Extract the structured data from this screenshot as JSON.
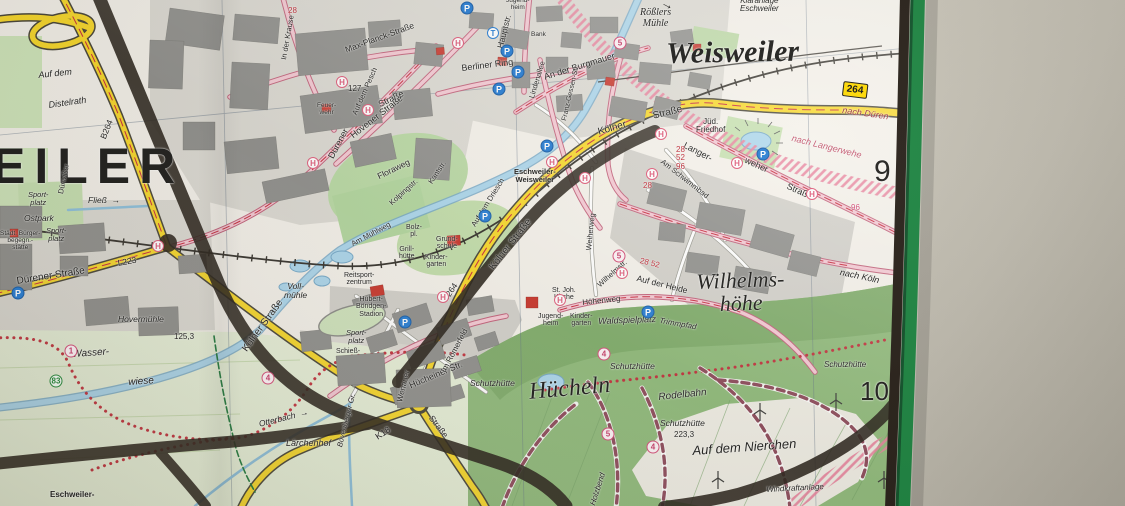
{
  "map": {
    "towns": [
      {
        "t": "Weisweiler"
      },
      {
        "t": "EILER"
      },
      {
        "t": "Wilhelms-\nhöhe"
      },
      {
        "t": "Hücheln"
      }
    ],
    "grid": [
      "9",
      "10"
    ],
    "labels": [
      {
        "t": "Rößlers\nMühle",
        "x": 640,
        "y": 8,
        "fs": 10,
        "s": "i ser ctr"
      },
      {
        "t": "Kläranlage\nEschweiler",
        "x": 740,
        "y": -3,
        "fs": 8,
        "s": "i ctr"
      },
      {
        "t": "nach Düren",
        "x": 843,
        "y": 106,
        "fs": 9,
        "r": 8,
        "s": "i",
        "c": "#9b2d35"
      },
      {
        "t": "nach Langerwehe",
        "x": 793,
        "y": 134,
        "fs": 9,
        "r": 14,
        "s": "i",
        "c": "#c2566e"
      },
      {
        "t": "nach Köln",
        "x": 841,
        "y": 268,
        "fs": 9,
        "r": 12,
        "s": "i"
      },
      {
        "t": "Jüd.\nFriedhof",
        "x": 696,
        "y": 118,
        "fs": 8,
        "s": "ctr"
      },
      {
        "t": "Langer-",
        "x": 686,
        "y": 141,
        "fs": 9,
        "r": 27
      },
      {
        "t": "weher",
        "x": 747,
        "y": 156,
        "fs": 9,
        "r": 24
      },
      {
        "t": "Straße",
        "x": 789,
        "y": 182,
        "fs": 9,
        "r": 24
      },
      {
        "t": "28\n52\n96",
        "x": 676,
        "y": 146,
        "fs": 8,
        "s": "ctr",
        "c": "#bf2f3a"
      },
      {
        "t": "Am Schwimmbad",
        "x": 664,
        "y": 158,
        "fs": 7.5,
        "r": 38
      },
      {
        "t": "Auf der Heide",
        "x": 638,
        "y": 274,
        "fs": 8.5,
        "r": 14
      },
      {
        "t": "28 52",
        "x": 641,
        "y": 257,
        "fs": 8,
        "r": 14,
        "c": "#bf2f3a"
      },
      {
        "t": "96",
        "x": 851,
        "y": 204,
        "fs": 8,
        "c": "#d4507a"
      },
      {
        "t": "28",
        "x": 643,
        "y": 182,
        "fs": 8,
        "c": "#bf2f3a"
      },
      {
        "t": "Kölner",
        "x": 597,
        "y": 128,
        "fs": 10,
        "r": -16
      },
      {
        "t": "Straße",
        "x": 652,
        "y": 112,
        "fs": 10,
        "r": -14
      },
      {
        "t": "Kölner Straße",
        "x": 488,
        "y": 266,
        "fs": 10,
        "r": -52
      },
      {
        "t": "B264",
        "x": 441,
        "y": 298,
        "fs": 8.5,
        "r": -56
      },
      {
        "t": "B264",
        "x": 99,
        "y": 137,
        "fs": 8.5,
        "r": -68
      },
      {
        "t": "Kölner Straße",
        "x": 241,
        "y": 348,
        "fs": 10,
        "r": -54
      },
      {
        "t": "Dürener Straße",
        "x": 16,
        "y": 277,
        "fs": 10,
        "r": -9
      },
      {
        "t": "L223",
        "x": 117,
        "y": 259,
        "fs": 8.5,
        "r": -10
      },
      {
        "t": "K18",
        "x": 374,
        "y": 434,
        "fs": 9,
        "r": -33
      },
      {
        "t": "Wenauer",
        "x": 396,
        "y": 401,
        "fs": 8,
        "r": -76
      },
      {
        "t": "Straße",
        "x": 434,
        "y": 414,
        "fs": 8.5,
        "r": 52
      },
      {
        "t": "Dürener",
        "x": 327,
        "y": 156,
        "fs": 9,
        "r": -62
      },
      {
        "t": "Straße",
        "x": 377,
        "y": 101,
        "fs": 9,
        "r": -26
      },
      {
        "t": "Hovener Straße",
        "x": 349,
        "y": 133,
        "fs": 9,
        "r": -38
      },
      {
        "t": "Max-Planck-Straße",
        "x": 344,
        "y": 46,
        "fs": 8.5,
        "r": -20
      },
      {
        "t": "Auf dem Pesch",
        "x": 351,
        "y": 113,
        "fs": 7.5,
        "r": -66
      },
      {
        "t": "In der Krause",
        "x": 280,
        "y": 59,
        "fs": 7.5,
        "r": -80
      },
      {
        "t": "Berliner Ring",
        "x": 461,
        "y": 64,
        "fs": 9,
        "r": -7
      },
      {
        "t": "Hauptstr.",
        "x": 496,
        "y": 47,
        "fs": 8.5,
        "r": -76
      },
      {
        "t": "An der Burgmauer",
        "x": 543,
        "y": 73,
        "fs": 9,
        "r": -17
      },
      {
        "t": "Franz-Gessen-Str.",
        "x": 561,
        "y": 120,
        "fs": 7,
        "r": -77
      },
      {
        "t": "Lindenallee",
        "x": 528,
        "y": 97,
        "fs": 7.5,
        "r": -73
      },
      {
        "t": "Floraweg",
        "x": 376,
        "y": 173,
        "fs": 8.5,
        "r": -26
      },
      {
        "t": "Kolpingstr.",
        "x": 388,
        "y": 201,
        "fs": 7.5,
        "r": -42
      },
      {
        "t": "Kantstr.",
        "x": 427,
        "y": 181,
        "fs": 7.5,
        "r": -56
      },
      {
        "t": "Auf dem Driesch",
        "x": 470,
        "y": 224,
        "fs": 7.5,
        "r": -58
      },
      {
        "t": "Am Mühlweg",
        "x": 350,
        "y": 241,
        "fs": 7.5,
        "r": -28
      },
      {
        "t": "Eschweiler-\nWeisweiler",
        "x": 514,
        "y": 168,
        "fs": 7.5,
        "s": "b ctr"
      },
      {
        "t": "Bolz-\npl.",
        "x": 406,
        "y": 224,
        "fs": 7,
        "s": "ctr"
      },
      {
        "t": "Grill-\nhütte",
        "x": 399,
        "y": 246,
        "fs": 7,
        "s": "ctr"
      },
      {
        "t": "Grund-\nschule",
        "x": 436,
        "y": 236,
        "fs": 7,
        "s": "ctr"
      },
      {
        "t": "Kinder-\ngarten",
        "x": 425,
        "y": 254,
        "fs": 7,
        "s": "ctr"
      },
      {
        "t": "Sport-\nplatz",
        "x": 28,
        "y": 191,
        "fs": 7.5,
        "s": "i ctr"
      },
      {
        "t": "Ostpark",
        "x": 24,
        "y": 214,
        "fs": 8.5,
        "s": "i"
      },
      {
        "t": "Sport-\nplatz",
        "x": 46,
        "y": 227,
        "fs": 7.5,
        "s": "i ctr"
      },
      {
        "t": "Städt. Bürger-\nbegegn.-\nstätte",
        "x": 0,
        "y": 231,
        "fs": 6.5,
        "s": "ctr"
      },
      {
        "t": "Dürwißer",
        "x": 57,
        "y": 193,
        "fs": 7.5,
        "r": -78
      },
      {
        "t": "Fließ  →",
        "x": 88,
        "y": 196,
        "fs": 8.5,
        "s": "i"
      },
      {
        "t": "Hovermühle",
        "x": 118,
        "y": 315,
        "fs": 8.5,
        "s": "i"
      },
      {
        "t": "125,3",
        "x": 174,
        "y": 333,
        "fs": 8
      },
      {
        "t": "Wasser-",
        "x": 72,
        "y": 350,
        "fs": 10,
        "r": -4,
        "s": "i"
      },
      {
        "t": "wiese",
        "x": 128,
        "y": 378,
        "fs": 10,
        "r": -4,
        "s": "i"
      },
      {
        "t": "Otterbach  →",
        "x": 258,
        "y": 420,
        "fs": 8.5,
        "r": -14,
        "s": "i"
      },
      {
        "t": "Bovenberger Gr.",
        "x": 336,
        "y": 446,
        "fs": 7.5,
        "r": -76,
        "s": "i"
      },
      {
        "t": "Lärchenhof",
        "x": 286,
        "y": 439,
        "fs": 9,
        "s": "i"
      },
      {
        "t": "Voll-\nmühle",
        "x": 284,
        "y": 282,
        "fs": 8.5,
        "s": "i ctr"
      },
      {
        "t": "Reitsport-\nzentrum",
        "x": 344,
        "y": 272,
        "fs": 7,
        "s": "ctr"
      },
      {
        "t": "Hubert-\nBöndgen-\nStadion",
        "x": 356,
        "y": 296,
        "fs": 7,
        "s": "ctr"
      },
      {
        "t": "Sport-\nplatz",
        "x": 346,
        "y": 329,
        "fs": 7.5,
        "s": "i ctr"
      },
      {
        "t": "Schieß-",
        "x": 336,
        "y": 348,
        "fs": 7
      },
      {
        "t": "Hücheiner Str.",
        "x": 408,
        "y": 382,
        "fs": 9,
        "r": -23
      },
      {
        "t": "Im Römerfeld",
        "x": 440,
        "y": 370,
        "fs": 8,
        "r": -62
      },
      {
        "t": "St. Joh.\nKirche",
        "x": 552,
        "y": 287,
        "fs": 7,
        "s": "ctr"
      },
      {
        "t": "Jugend-\nheim",
        "x": 538,
        "y": 313,
        "fs": 7,
        "s": "ctr"
      },
      {
        "t": "Kinder-\ngarten",
        "x": 570,
        "y": 313,
        "fs": 7,
        "s": "ctr"
      },
      {
        "t": "Waldspielplatz",
        "x": 598,
        "y": 317,
        "fs": 9,
        "r": -2,
        "s": "i"
      },
      {
        "t": "Trimmpfad",
        "x": 660,
        "y": 317,
        "fs": 8,
        "r": 10,
        "s": "i"
      },
      {
        "t": "Höhenweg",
        "x": 582,
        "y": 299,
        "fs": 8,
        "r": -6
      },
      {
        "t": "Wilhelmstr.",
        "x": 596,
        "y": 283,
        "fs": 7.5,
        "r": -42
      },
      {
        "t": "Weiherweg",
        "x": 585,
        "y": 250,
        "fs": 7.5,
        "r": -84
      },
      {
        "t": "Schutzhütte",
        "x": 470,
        "y": 379,
        "fs": 8.5,
        "s": "i"
      },
      {
        "t": "Schutzhütte",
        "x": 610,
        "y": 362,
        "fs": 8.5,
        "s": "i"
      },
      {
        "t": "Schutzhütte",
        "x": 660,
        "y": 419,
        "fs": 8.5,
        "s": "i"
      },
      {
        "t": "223,3",
        "x": 674,
        "y": 431,
        "fs": 8
      },
      {
        "t": "Schutzhütte",
        "x": 824,
        "y": 361,
        "fs": 8,
        "s": "i"
      },
      {
        "t": "Rodelbahn",
        "x": 658,
        "y": 393,
        "fs": 10,
        "r": -6,
        "s": "i"
      },
      {
        "t": "Auf dem Nierchen",
        "x": 692,
        "y": 444,
        "fs": 13,
        "r": -4,
        "s": "i"
      },
      {
        "t": "Windkraftanlage",
        "x": 766,
        "y": 486,
        "fs": 8,
        "r": -3,
        "s": "i"
      },
      {
        "t": "Auf dem",
        "x": 38,
        "y": 71,
        "fs": 9,
        "r": -6,
        "s": "i"
      },
      {
        "t": "Distelrath",
        "x": 48,
        "y": 101,
        "fs": 9,
        "r": -8,
        "s": "i"
      },
      {
        "t": "Eschweiler-",
        "x": 50,
        "y": 491,
        "fs": 8,
        "s": "b"
      },
      {
        "t": "Holzbend",
        "x": 589,
        "y": 504,
        "fs": 8,
        "r": -72,
        "s": "i"
      },
      {
        "t": "Feuer-\nwehr",
        "x": 317,
        "y": 103,
        "fs": 6.5,
        "s": "ctr"
      },
      {
        "t": "Bank",
        "x": 531,
        "y": 32,
        "fs": 6.5
      },
      {
        "t": "28",
        "x": 288,
        "y": 7,
        "fs": 8,
        "c": "#bf2f3a"
      },
      {
        "t": "127",
        "x": 348,
        "y": 85,
        "fs": 8
      },
      {
        "t": "Jugend-\nheim",
        "x": 506,
        "y": -2,
        "fs": 6.5,
        "s": "ctr"
      }
    ],
    "icons": [
      {
        "k": "H",
        "t": "H",
        "x": 342,
        "y": 82
      },
      {
        "k": "H",
        "t": "H",
        "x": 368,
        "y": 110
      },
      {
        "k": "H",
        "t": "H",
        "x": 458,
        "y": 43
      },
      {
        "k": "H",
        "t": "H",
        "x": 313,
        "y": 163
      },
      {
        "k": "H",
        "t": "H",
        "x": 158,
        "y": 246
      },
      {
        "k": "H",
        "t": "H",
        "x": 552,
        "y": 162
      },
      {
        "k": "H",
        "t": "H",
        "x": 585,
        "y": 178
      },
      {
        "k": "H",
        "t": "H",
        "x": 652,
        "y": 174
      },
      {
        "k": "H",
        "t": "H",
        "x": 661,
        "y": 134
      },
      {
        "k": "H",
        "t": "H",
        "x": 737,
        "y": 163
      },
      {
        "k": "H",
        "t": "H",
        "x": 812,
        "y": 194
      },
      {
        "k": "H",
        "t": "H",
        "x": 622,
        "y": 273
      },
      {
        "k": "H",
        "t": "H",
        "x": 560,
        "y": 300
      },
      {
        "k": "H",
        "t": "H",
        "x": 443,
        "y": 297
      },
      {
        "k": "P",
        "t": "P",
        "x": 467,
        "y": 8
      },
      {
        "k": "P",
        "t": "P",
        "x": 507,
        "y": 51
      },
      {
        "k": "P",
        "t": "P",
        "x": 518,
        "y": 72
      },
      {
        "k": "P",
        "t": "P",
        "x": 499,
        "y": 89
      },
      {
        "k": "P",
        "t": "P",
        "x": 547,
        "y": 146
      },
      {
        "k": "P",
        "t": "P",
        "x": 485,
        "y": 216
      },
      {
        "k": "P",
        "t": "P",
        "x": 405,
        "y": 322
      },
      {
        "k": "P",
        "t": "P",
        "x": 648,
        "y": 312
      },
      {
        "k": "P",
        "t": "P",
        "x": 763,
        "y": 154
      },
      {
        "k": "P",
        "t": "P",
        "x": 18,
        "y": 293
      },
      {
        "k": "T",
        "t": "T",
        "x": 493,
        "y": 33
      },
      {
        "k": "r",
        "t": "5",
        "x": 620,
        "y": 43
      },
      {
        "k": "r",
        "t": "5",
        "x": 619,
        "y": 256
      },
      {
        "k": "r",
        "t": "5",
        "x": 608,
        "y": 434
      },
      {
        "k": "r",
        "t": "4",
        "x": 268,
        "y": 378
      },
      {
        "k": "r",
        "t": "4",
        "x": 604,
        "y": 354
      },
      {
        "k": "r",
        "t": "4",
        "x": 653,
        "y": 447
      },
      {
        "k": "r",
        "t": "1",
        "x": 71,
        "y": 351
      },
      {
        "k": "rg",
        "t": "83",
        "x": 56,
        "y": 381
      },
      {
        "k": "b264",
        "t": "264",
        "x": 855,
        "y": 90
      },
      {
        "k": "arr",
        "t": "→",
        "x": 668,
        "y": 4
      }
    ]
  }
}
